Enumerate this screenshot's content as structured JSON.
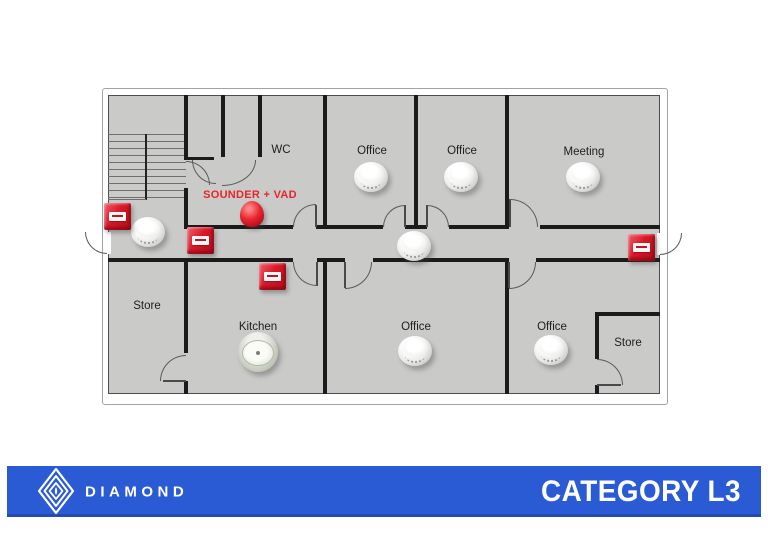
{
  "plan": {
    "rooms": [
      {
        "label": "WC"
      },
      {
        "label": "Office"
      },
      {
        "label": "Office"
      },
      {
        "label": "Meeting"
      },
      {
        "label": "Store"
      },
      {
        "label": "Kitchen"
      },
      {
        "label": "Office"
      },
      {
        "label": "Office"
      },
      {
        "label": "Store"
      }
    ],
    "annotation": {
      "sounder_vad_label": "SOUNDER + VAD"
    },
    "devices": [
      {
        "type": "manual-call-point",
        "count": 4
      },
      {
        "type": "smoke-detector",
        "count": 7
      },
      {
        "type": "heat-detector",
        "count": 1
      },
      {
        "type": "sounder-vad",
        "count": 1
      }
    ],
    "colors": {
      "floor": "#cacac9",
      "wall": "#1b1b1b",
      "device_red": "#d8141f",
      "annotation_red": "#e8242b"
    }
  },
  "banner": {
    "brand": "DIAMOND",
    "category": "CATEGORY L3",
    "background": "#2b5ad5"
  }
}
